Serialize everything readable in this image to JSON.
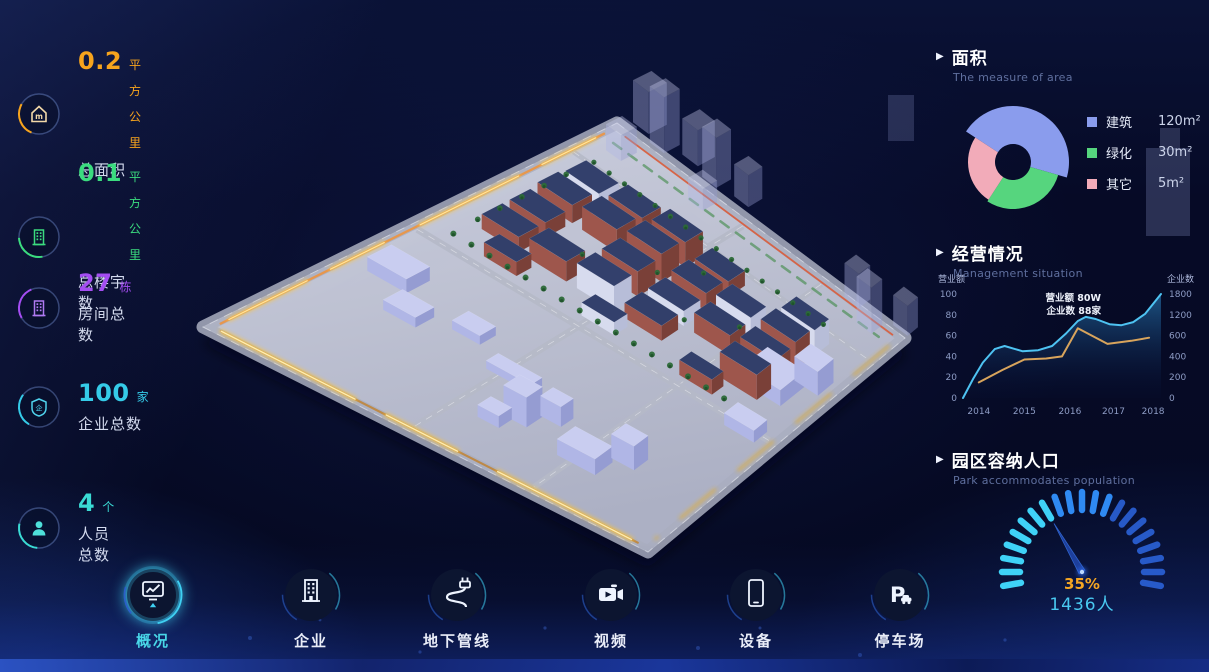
{
  "stats": [
    {
      "value": "0.2",
      "unit": "平方公里",
      "label": "总面积"
    },
    {
      "value": "0.1",
      "unit": "平方公里",
      "label": "总楼宇数"
    },
    {
      "value": "27",
      "unit": "栋",
      "label": "房间总数"
    },
    {
      "value": "100",
      "unit": "家",
      "label": "企业总数"
    },
    {
      "value": "4",
      "unit": "个",
      "label": "人员总数"
    }
  ],
  "panels": {
    "area": {
      "title": "面积",
      "subtitle": "The measure of area",
      "legend": [
        {
          "label": "建筑",
          "value": "120m²"
        },
        {
          "label": "绿化",
          "value": "30m²"
        },
        {
          "label": "其它",
          "value": "5m²"
        }
      ]
    },
    "management": {
      "title": "经营情况",
      "subtitle": "Management situation",
      "tooltip_line1": "营业额 80W",
      "tooltip_line2": "企业数 88家",
      "y_left_label": "营业额",
      "y_right_label": "企业数"
    },
    "population": {
      "title": "园区容纳人口",
      "subtitle": "Park accommodates population",
      "percent": "35%",
      "count": "1436人"
    }
  },
  "nav": [
    {
      "label": "概况",
      "active": true
    },
    {
      "label": "企业",
      "active": false
    },
    {
      "label": "地下管线",
      "active": false
    },
    {
      "label": "视频",
      "active": false
    },
    {
      "label": "设备",
      "active": false
    },
    {
      "label": "停车场",
      "active": false
    }
  ],
  "colors": {
    "stat_orange": "#f7a41d",
    "stat_green": "#3bdc7f",
    "stat_purple": "#a44df2",
    "stat_cyan": "#35cbe8",
    "stat_teal": "#3adbd4",
    "donut_building": "#8a9ced",
    "donut_green": "#56d57e",
    "donut_other": "#f2abb9",
    "line_revenue": "#4ec3f2",
    "line_enterprise": "#d8a45c",
    "gauge_bright": "#3fd2f7",
    "gauge_mid": "#2f8af2",
    "gauge_dim": "#2b62d8",
    "nav_active": "#49d7e8",
    "road_glow": "#ffc435"
  },
  "chart_data": [
    {
      "type": "pie",
      "style": "rose-donut",
      "title": "面积",
      "labels": [
        "建筑",
        "绿化",
        "其它"
      ],
      "values": [
        120,
        30,
        5
      ],
      "unit": "m²",
      "colors": [
        "#8a9ced",
        "#56d57e",
        "#f2abb9"
      ],
      "display": {
        "inner_radius": 18,
        "segments": [
          {
            "start_deg": -57,
            "sweep_deg": 163,
            "outer_radius": 56
          },
          {
            "start_deg": 106,
            "sweep_deg": 107,
            "outer_radius": 47
          },
          {
            "start_deg": 213,
            "sweep_deg": 90,
            "outer_radius": 45
          }
        ]
      }
    },
    {
      "type": "line",
      "title": "经营情况",
      "grid": false,
      "legend_position": "none",
      "x_ticks": [
        "2014",
        "2015",
        "2016",
        "2017",
        "2018"
      ],
      "x_tick_frac": [
        0.08,
        0.31,
        0.54,
        0.76,
        0.96
      ],
      "y_left": {
        "label": "营业额",
        "ticks": [
          0,
          20,
          40,
          60,
          80,
          100
        ],
        "range": [
          0,
          100
        ]
      },
      "y_right": {
        "label": "企业数",
        "ticks": [
          0,
          200,
          400,
          600,
          1200,
          1800
        ]
      },
      "annotation": [
        "营业额 80W",
        "企业数 88家"
      ],
      "series": [
        {
          "name": "营业额",
          "color": "#4ec3f2",
          "area": true,
          "points": [
            [
              0,
              0
            ],
            [
              0.05,
              18
            ],
            [
              0.1,
              34
            ],
            [
              0.16,
              47
            ],
            [
              0.21,
              50
            ],
            [
              0.3,
              45
            ],
            [
              0.38,
              46
            ],
            [
              0.45,
              50
            ],
            [
              0.52,
              62
            ],
            [
              0.58,
              74
            ],
            [
              0.62,
              78
            ],
            [
              0.67,
              76
            ],
            [
              0.74,
              71
            ],
            [
              0.8,
              70
            ],
            [
              0.86,
              73
            ],
            [
              0.92,
              81
            ],
            [
              1,
              100
            ]
          ]
        },
        {
          "name": "企业数",
          "color": "#d8a45c",
          "area": false,
          "points": [
            [
              0.08,
              15
            ],
            [
              0.2,
              27
            ],
            [
              0.31,
              37
            ],
            [
              0.42,
              38
            ],
            [
              0.5,
              40
            ],
            [
              0.58,
              67
            ],
            [
              0.73,
              52
            ],
            [
              0.85,
              55
            ],
            [
              0.94,
              58
            ]
          ]
        }
      ]
    },
    {
      "type": "gauge",
      "title": "园区容纳人口",
      "percent": 35,
      "value_label": "1436人",
      "ticks": 21,
      "start_deg": 190,
      "end_deg": -10
    }
  ]
}
